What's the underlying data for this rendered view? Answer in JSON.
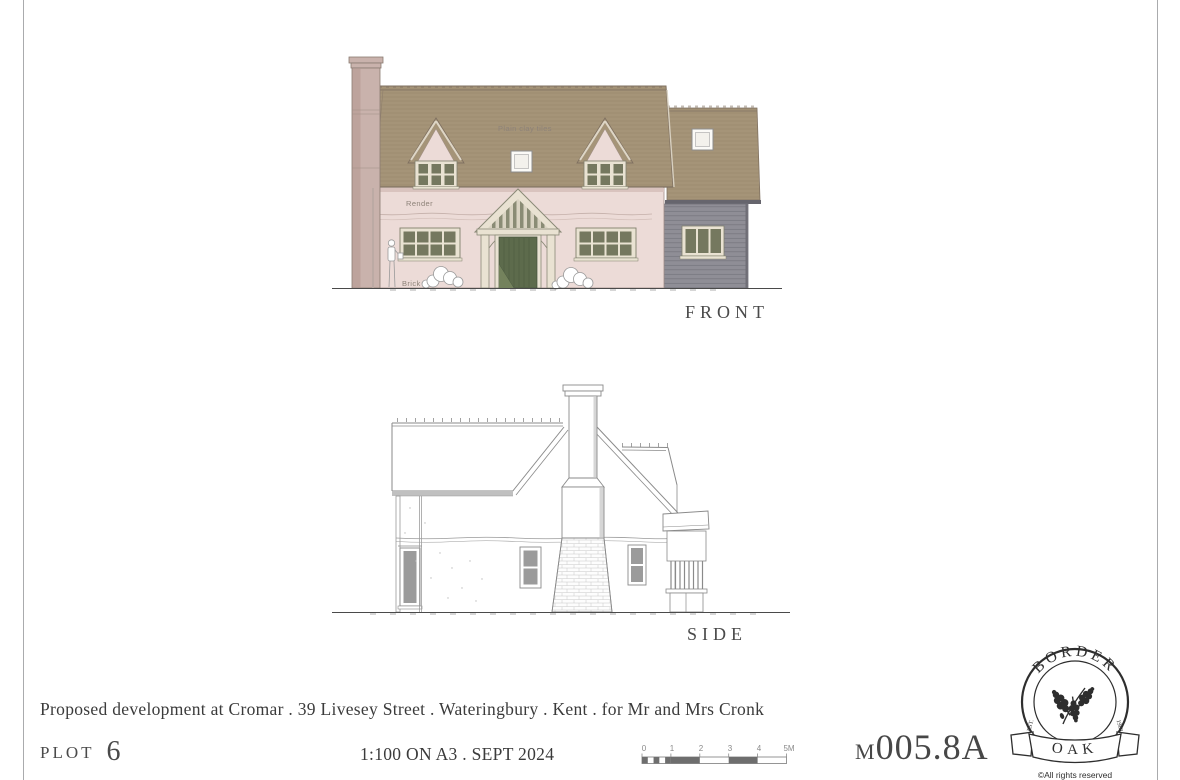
{
  "colors": {
    "roof": "#a59478",
    "roof-hatch": "#8d7c64",
    "render": "#ecdbd7",
    "chimney": "#c9b2ac",
    "chimney-shade": "#b2978f",
    "glazing": "#75785f",
    "door": "#5d6b4c",
    "frame": "#e9e2d2",
    "cladding": "#8f8e96",
    "line": "#8a8a8a",
    "ink": "#3b3b3b",
    "label": "#8d8278"
  },
  "front_elevation": {
    "label": "FRONT",
    "labels": {
      "roof": "Plain clay tiles",
      "wall": "Render",
      "plinth": "Brick"
    }
  },
  "side_elevation": {
    "label": "SIDE"
  },
  "title_block": {
    "project_title": "Proposed development at Cromar . 39 Livesey Street . Wateringbury . Kent . for Mr and Mrs Cronk",
    "plot_label": "PLOT",
    "plot_number": "6",
    "scale_note": "1:100 ON A3 . SEPT 2024",
    "drawing_number_prefix": "M",
    "drawing_number": "005.8A"
  },
  "scale_bar": {
    "ticks": [
      "0",
      "1",
      "2",
      "3",
      "4",
      "5M"
    ]
  },
  "logo": {
    "arc_text": "BORDER",
    "banner_text": "OAK",
    "est": "EST.",
    "year": "1980",
    "rights": "©All rights reserved"
  }
}
